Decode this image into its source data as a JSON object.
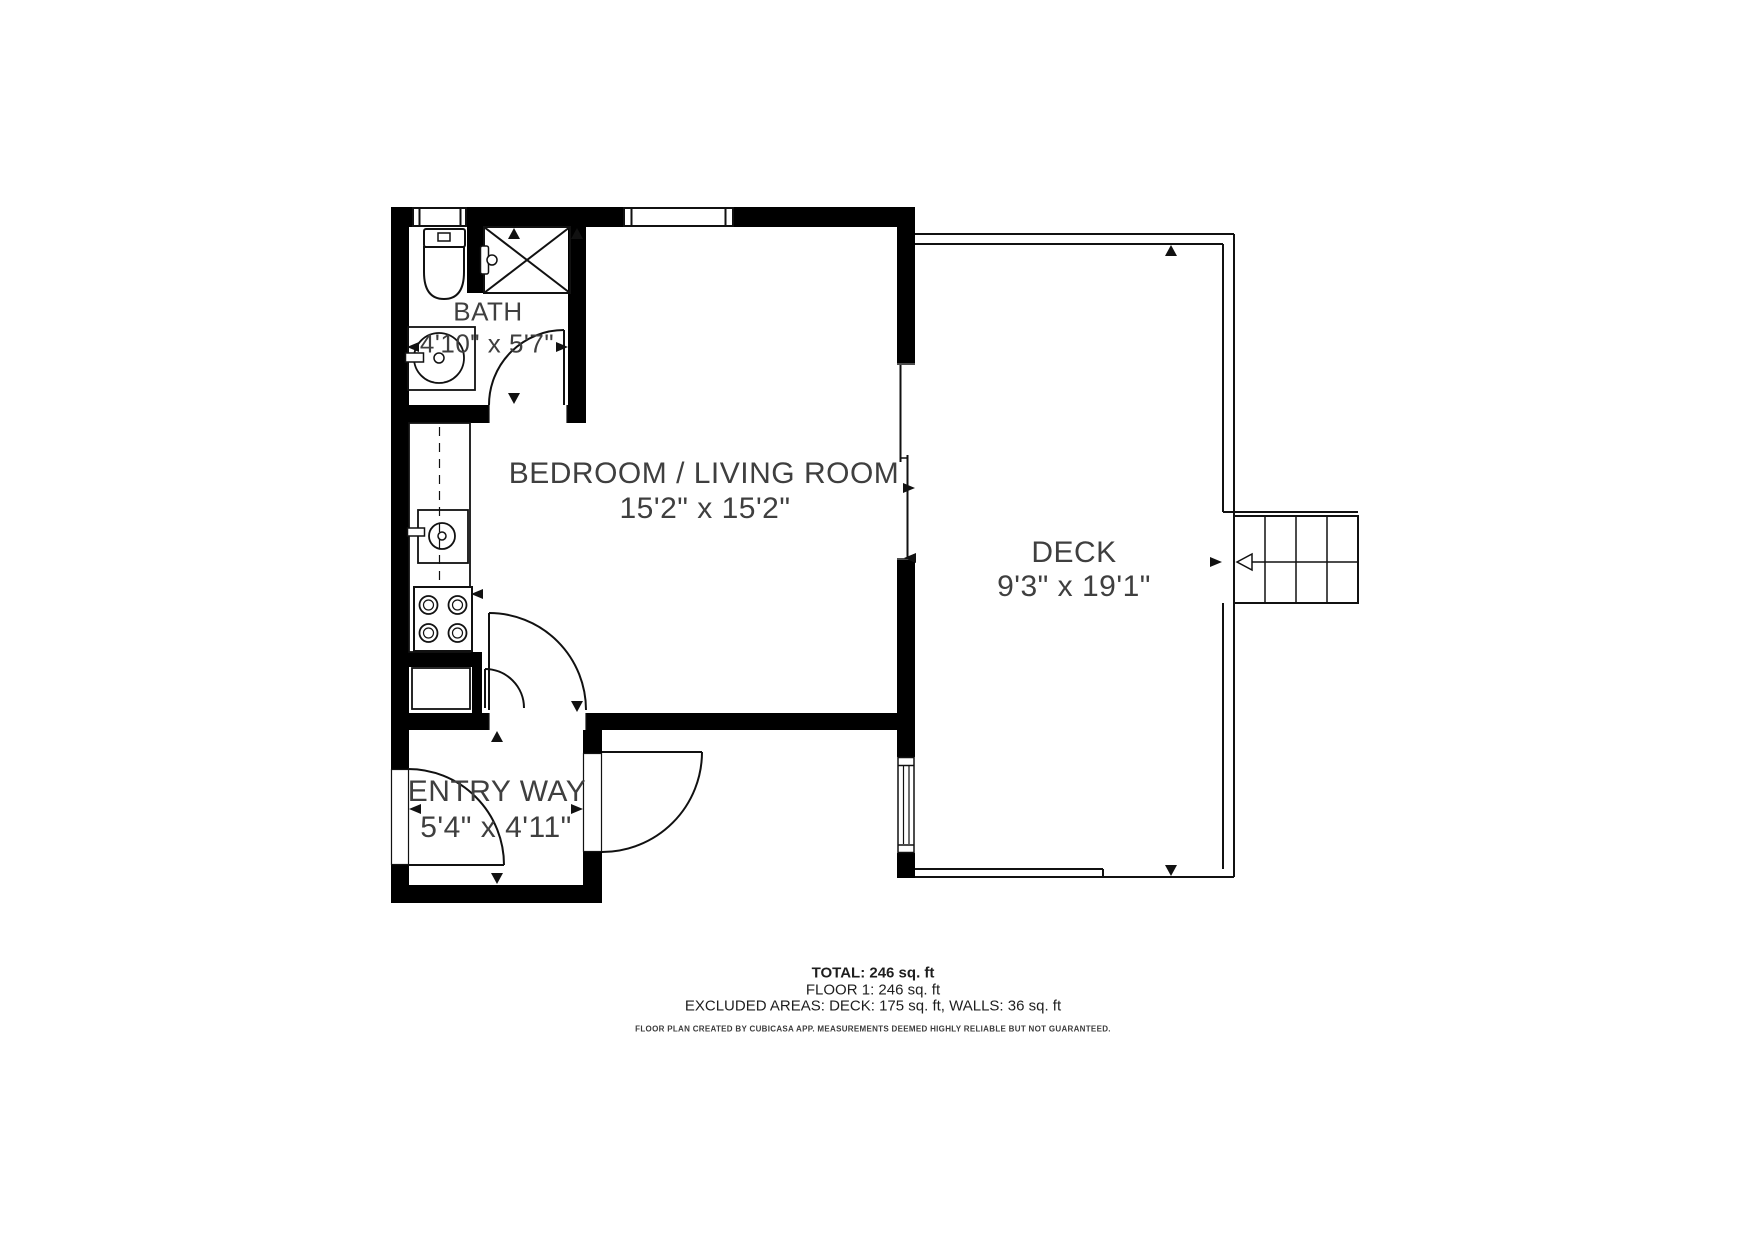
{
  "plan": {
    "rooms": [
      {
        "name": "BATH",
        "dimensions": "4'10\" x 5'7\""
      },
      {
        "name": "BEDROOM / LIVING ROOM",
        "dimensions": "15'2\" x 15'2\""
      },
      {
        "name": "DECK",
        "dimensions": "9'3\" x 19'1\""
      },
      {
        "name": "ENTRY WAY",
        "dimensions": "5'4\" x 4'11\""
      }
    ],
    "fixtures": [
      "toilet-icon",
      "shower-icon",
      "bathroom-sink-icon",
      "kitchen-counter",
      "kitchen-sink-icon",
      "stove-icon",
      "appliance-icon",
      "stairs-icon"
    ],
    "colors": {
      "wall": "#000000",
      "line": "#111111",
      "text": "#3f3f3f"
    }
  },
  "summary": {
    "total": "TOTAL: 246 sq. ft",
    "floor1": "FLOOR 1: 246 sq. ft",
    "excluded": "EXCLUDED AREAS: DECK: 175 sq. ft, WALLS: 36 sq. ft",
    "disclaimer": "FLOOR PLAN CREATED BY CUBICASA APP. MEASUREMENTS DEEMED HIGHLY RELIABLE BUT NOT GUARANTEED."
  }
}
